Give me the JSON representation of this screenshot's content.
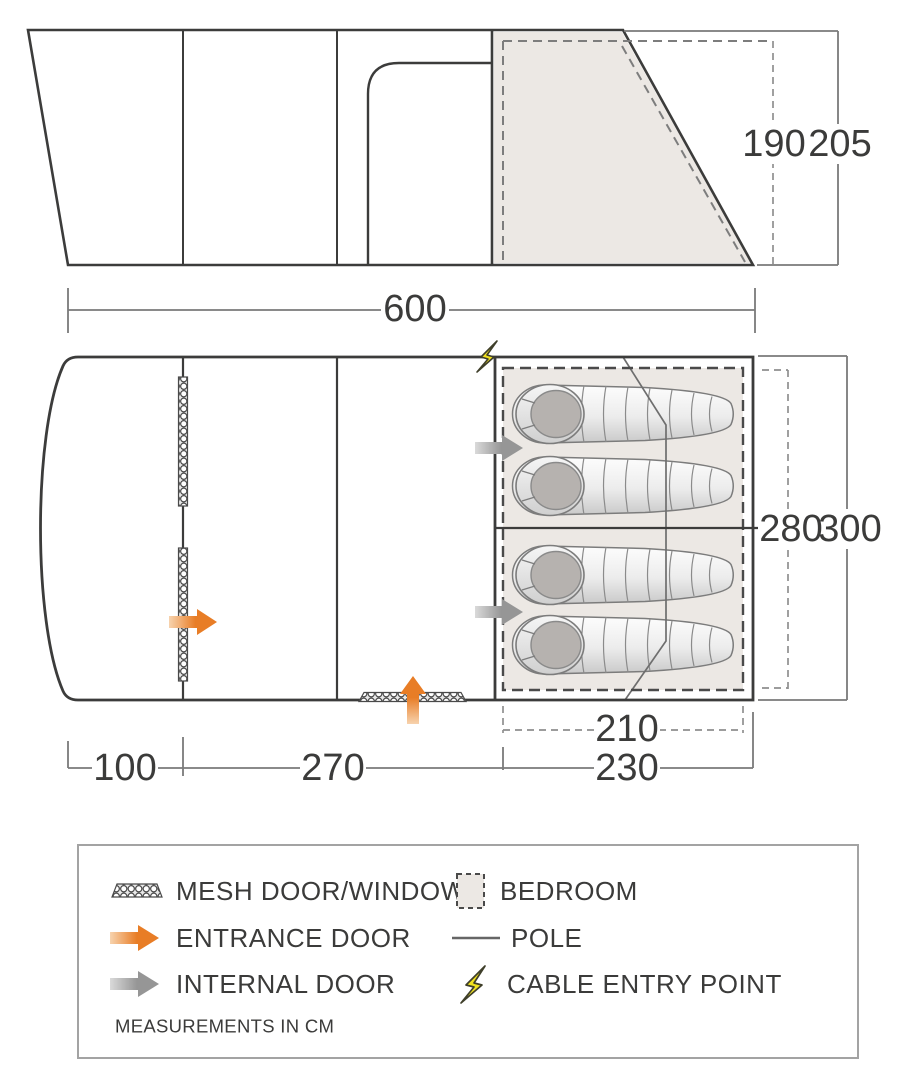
{
  "colors": {
    "accent_orange": "#e87d26",
    "internal_gray": "#9a9a9a",
    "bolt_yellow": "#f1e11f",
    "bedroom_fill": "#ece8e4",
    "line_dark": "#3c3c3b",
    "dim_gray": "#7a7a7a"
  },
  "elevation": {
    "length": "600",
    "inner_height": "190",
    "outer_height": "205"
  },
  "floorplan": {
    "inner_width": "280",
    "outer_width": "300",
    "bedroom_length": "210",
    "front_length": "100",
    "middle_length": "270",
    "rear_length": "230"
  },
  "legend": {
    "items": [
      {
        "label": "MESH DOOR/WINDOW"
      },
      {
        "label": "ENTRANCE DOOR"
      },
      {
        "label": "INTERNAL DOOR"
      },
      {
        "label": "BEDROOM"
      },
      {
        "label": "POLE"
      },
      {
        "label": "CABLE ENTRY POINT"
      }
    ],
    "note": "MEASUREMENTS IN CM"
  }
}
